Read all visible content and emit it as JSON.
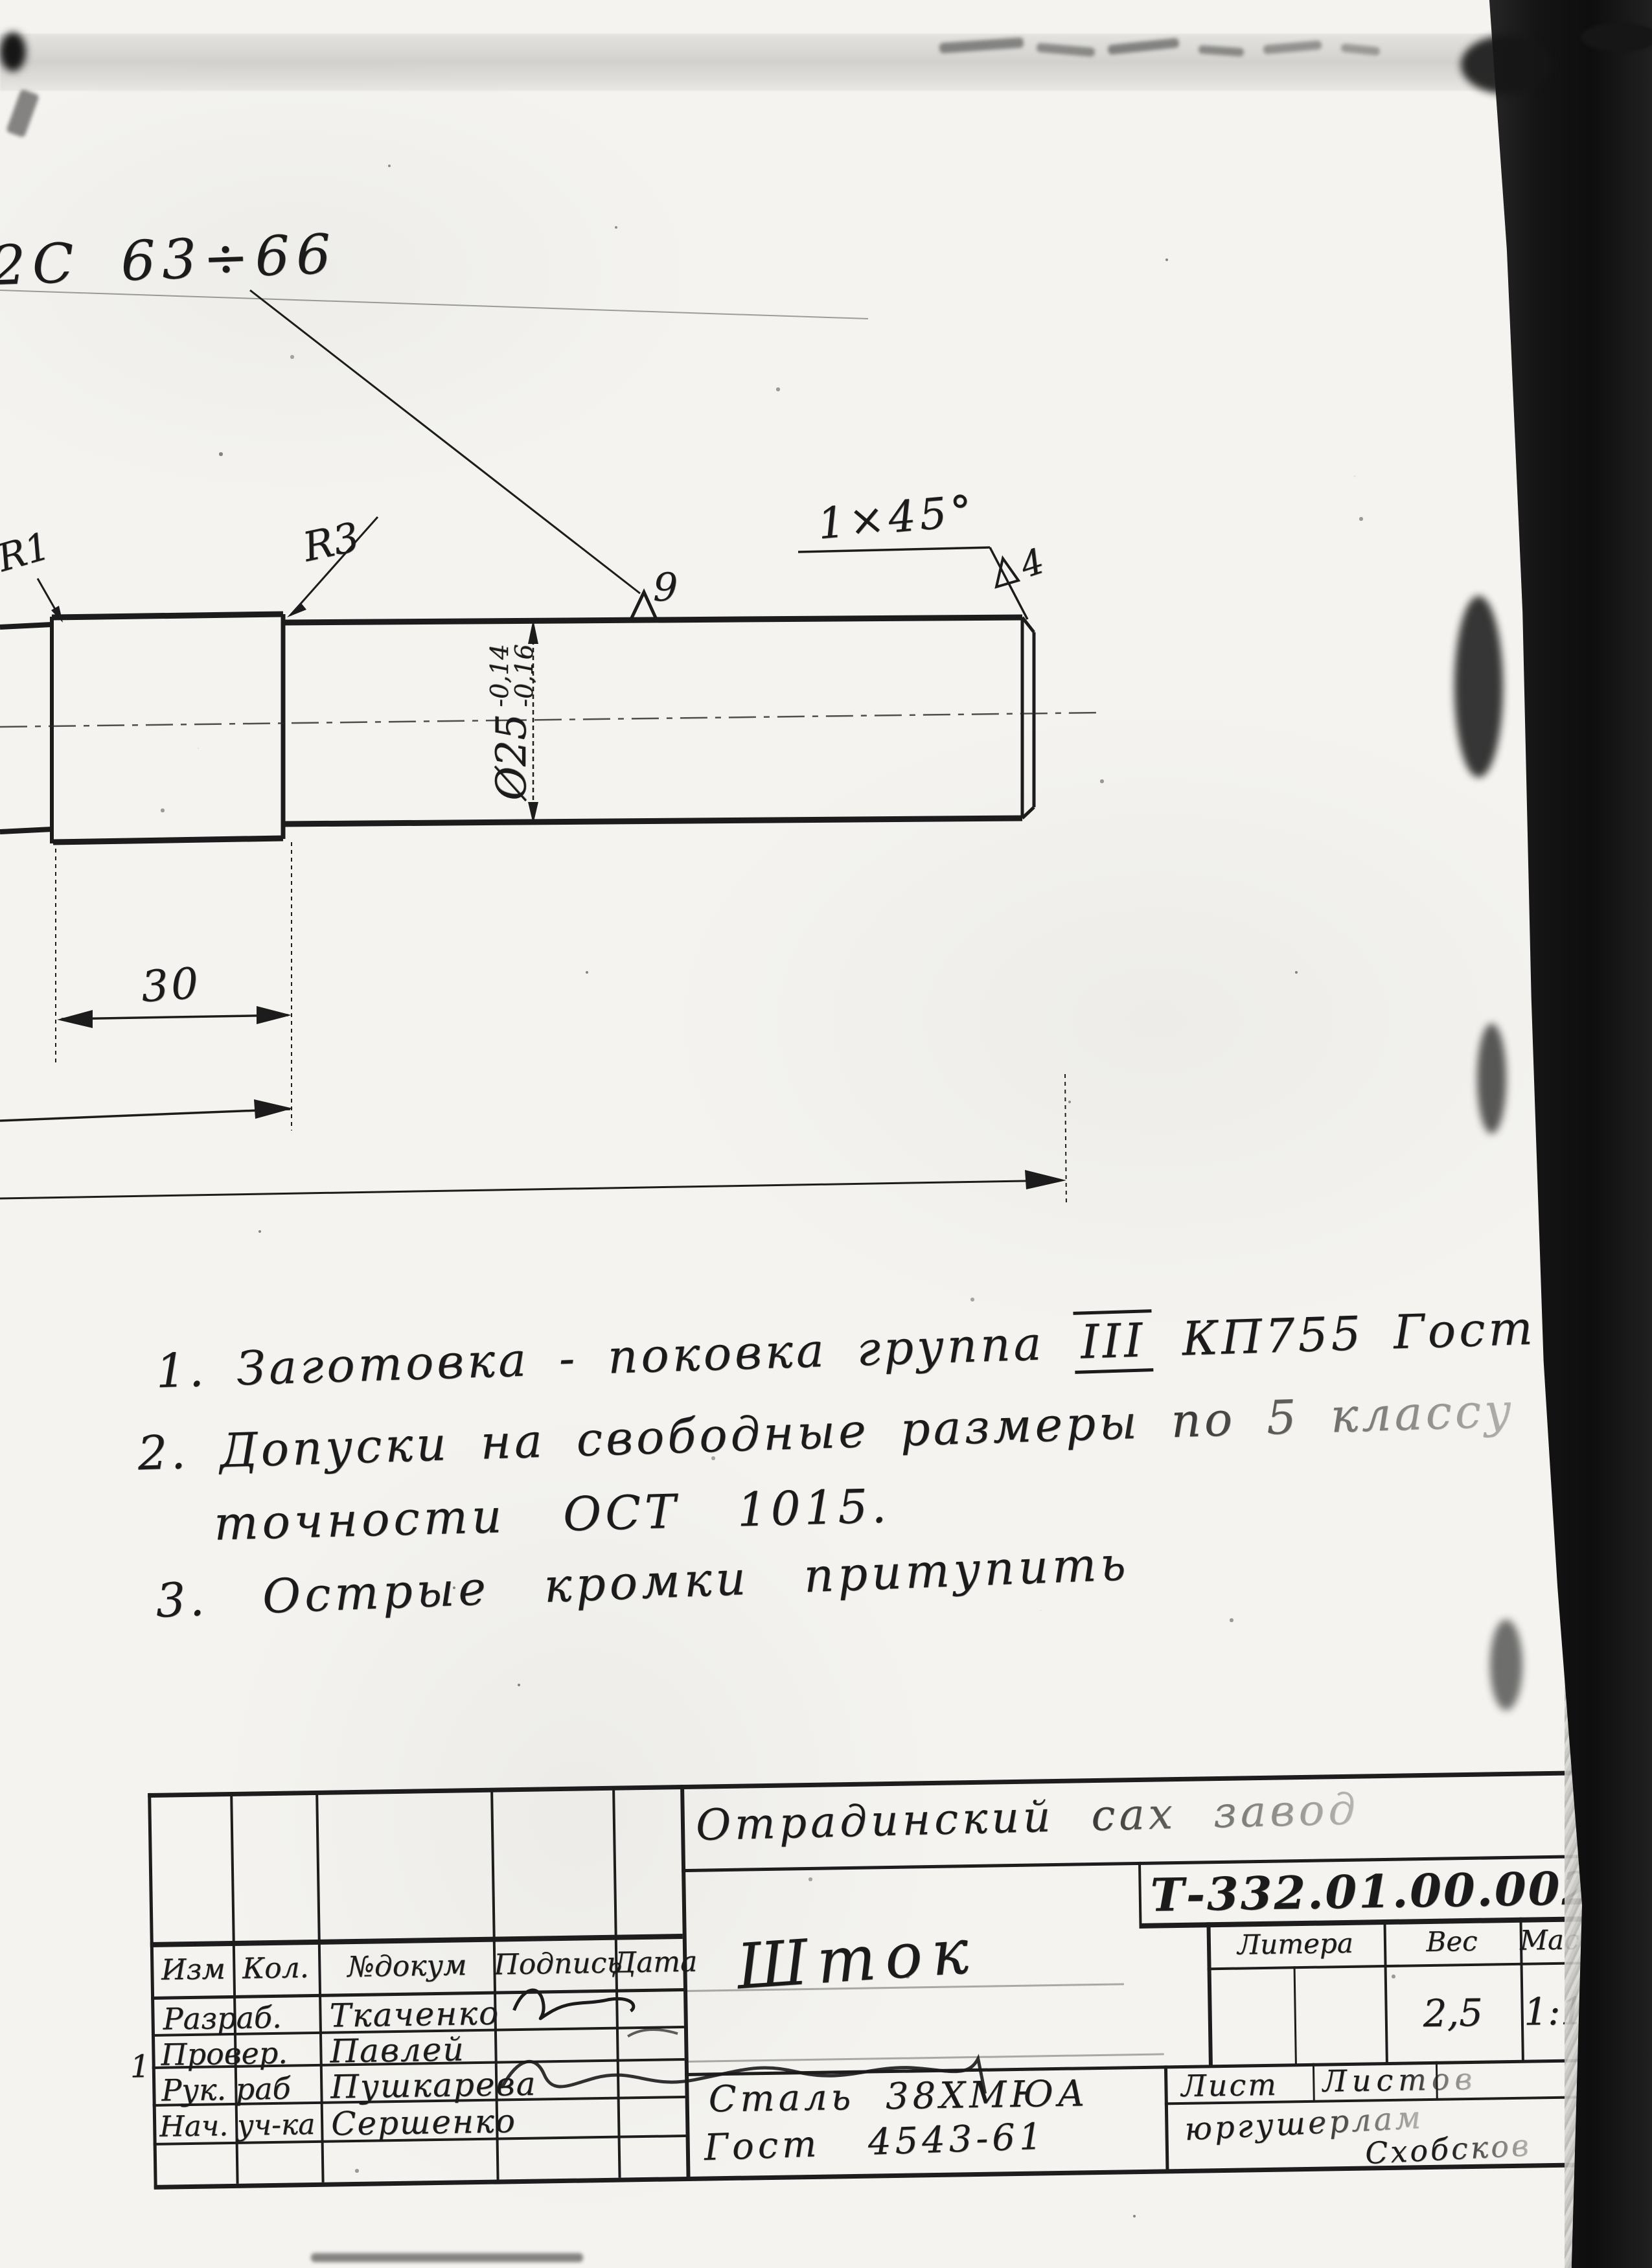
{
  "callouts": {
    "surface_range": "2C 63÷66",
    "radius_small": "R1",
    "radius_step": "R3",
    "roughness_shaft": "9",
    "chamfer": "1×45°",
    "roughness_end": "4",
    "diameter": "Ø25",
    "diameter_tol_upper": "-0,14",
    "diameter_tol_lower": "-0,16",
    "length_step": "30"
  },
  "notes": {
    "line1_prefix": "1. Заготовка - поковка группа",
    "line1_roman": "III",
    "line1_suffix": "КП755 Гост 8479-57",
    "line2": "2. Допуски на свободные размеры по 5 классу",
    "line3": "точности ОСТ 1015.",
    "line4": "3. Острые кромки притупить"
  },
  "title_block": {
    "org_name": "Отрадинский сах завод",
    "doc_number": "Т-332.01.00.002",
    "part_name": "Шток",
    "material_line1": "Сталь 38ХМЮА",
    "material_line2": "Гост 4543-61",
    "litera_label": "Литера",
    "weight_label": "Вес",
    "scale_label": "Масшт",
    "weight_value": "2,5",
    "scale_value": "1:1",
    "sheet_label": "Лист",
    "sheets_label": "Листов",
    "footer_line1": "юргушерлам",
    "footer_line2": "Схобсков",
    "stray_mark": "1",
    "revision_header": {
      "izm": "Изм",
      "kol": "Кол.",
      "doc": "№докум",
      "sign": "Подпись",
      "date": "Дата"
    },
    "staff": [
      {
        "role": "Разраб.",
        "name": "Ткаченко"
      },
      {
        "role": "Провер.",
        "name": "Павлей"
      },
      {
        "role": "Рук. раб",
        "name": "Пушкарева"
      },
      {
        "role": "Нач. уч-ка",
        "name": "Сершенко"
      }
    ]
  },
  "colors": {
    "ink": "#1a1a1a",
    "paper": "#f4f3ef",
    "scan_band": "#141414"
  }
}
